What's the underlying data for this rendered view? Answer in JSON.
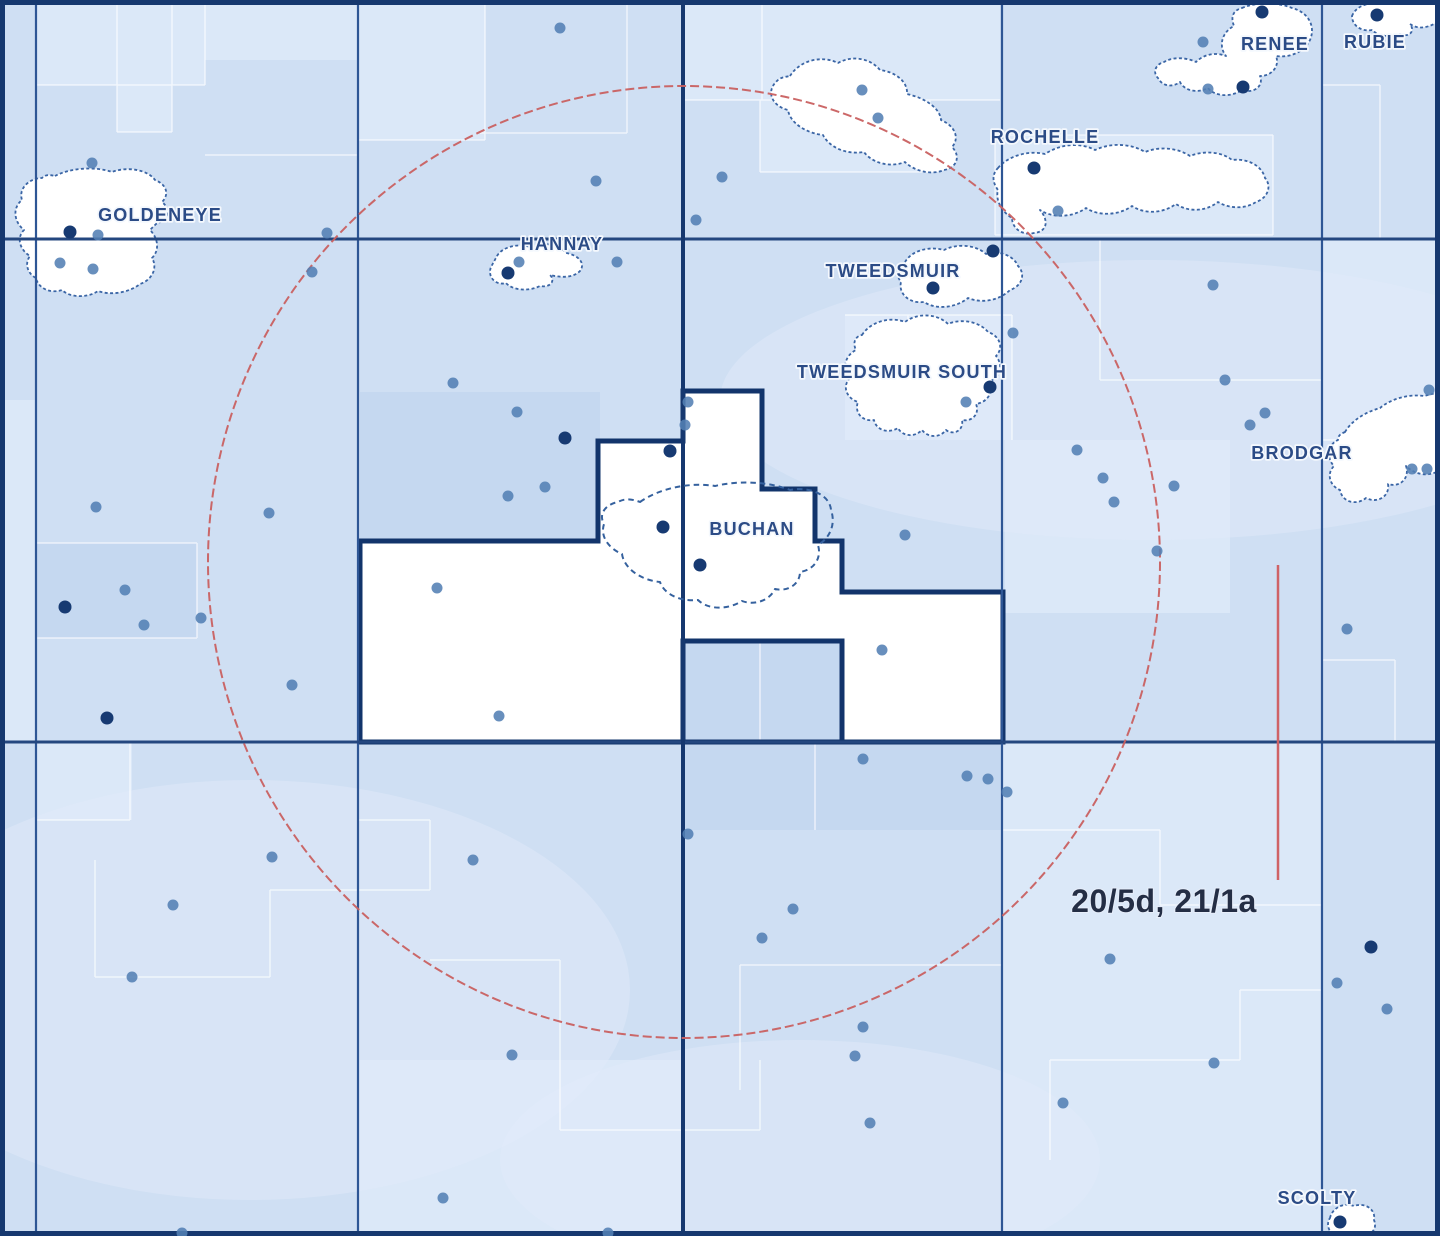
{
  "map": {
    "title": "Offshore licence blocks and fields map",
    "region_label": "20/5d, 21/1a",
    "fields": [
      {
        "id": "goldeneye",
        "label": "GOLDENEYE",
        "x": 160,
        "y": 221
      },
      {
        "id": "hannay",
        "label": "HANNAY",
        "x": 562,
        "y": 250
      },
      {
        "id": "rochelle",
        "label": "ROCHELLE",
        "x": 1045,
        "y": 143
      },
      {
        "id": "renee",
        "label": "RENEE",
        "x": 1275,
        "y": 50
      },
      {
        "id": "rubie",
        "label": "RUBIE",
        "x": 1375,
        "y": 48
      },
      {
        "id": "tweedsmuir",
        "label": "TWEEDSMUIR",
        "x": 893,
        "y": 277
      },
      {
        "id": "tweedsmuir-south",
        "label": "TWEEDSMUIR SOUTH",
        "x": 902,
        "y": 378
      },
      {
        "id": "buchan",
        "label": "BUCHAN",
        "x": 752,
        "y": 535
      },
      {
        "id": "brodgar",
        "label": "BRODGAR",
        "x": 1302,
        "y": 459
      },
      {
        "id": "scolty",
        "label": "SCOLTY",
        "x": 1317,
        "y": 1204
      }
    ],
    "colors": {
      "sea_base": "#cfdff3",
      "sea_light": "#dbe8f8",
      "sea_dark": "#c5d8f0",
      "grid_line": "#2e5695",
      "grid_major": "#16386f",
      "field_fill": "#ffffff",
      "field_outline": "#3a65a5",
      "licence_outline": "#12346b",
      "field_label_text": "#2b4b86",
      "block_label_text": "#242e45",
      "well_medium": "#537fb4",
      "well_dark": "#173a72",
      "radius_ring_red": "#c96060"
    },
    "wells": [
      [
        560,
        28
      ],
      [
        862,
        90
      ],
      [
        878,
        118
      ],
      [
        1203,
        42
      ],
      [
        1243,
        87,
        "d"
      ],
      [
        1208,
        89
      ],
      [
        1262,
        12,
        "d"
      ],
      [
        1377,
        15,
        "d"
      ],
      [
        92,
        163
      ],
      [
        70,
        232,
        "d"
      ],
      [
        98,
        235
      ],
      [
        60,
        263
      ],
      [
        93,
        269
      ],
      [
        327,
        233
      ],
      [
        312,
        272
      ],
      [
        596,
        181
      ],
      [
        722,
        177
      ],
      [
        696,
        220
      ],
      [
        1034,
        168,
        "d"
      ],
      [
        1058,
        211
      ],
      [
        1213,
        285
      ],
      [
        519,
        262
      ],
      [
        508,
        273,
        "d"
      ],
      [
        617,
        262
      ],
      [
        933,
        288,
        "d"
      ],
      [
        993,
        251,
        "d"
      ],
      [
        1013,
        333
      ],
      [
        453,
        383
      ],
      [
        517,
        412
      ],
      [
        565,
        438,
        "d"
      ],
      [
        545,
        487
      ],
      [
        508,
        496
      ],
      [
        990,
        387,
        "d"
      ],
      [
        966,
        402
      ],
      [
        1429,
        390
      ],
      [
        1225,
        380
      ],
      [
        1250,
        425
      ],
      [
        1265,
        413
      ],
      [
        1077,
        450
      ],
      [
        1103,
        478
      ],
      [
        1114,
        502
      ],
      [
        1174,
        486
      ],
      [
        1412,
        469
      ],
      [
        1427,
        469
      ],
      [
        1157,
        551
      ],
      [
        1347,
        629
      ],
      [
        688,
        402
      ],
      [
        685,
        425
      ],
      [
        670,
        451,
        "d"
      ],
      [
        663,
        527,
        "d"
      ],
      [
        700,
        565,
        "d"
      ],
      [
        905,
        535
      ],
      [
        882,
        650
      ],
      [
        437,
        588
      ],
      [
        499,
        716
      ],
      [
        96,
        507
      ],
      [
        269,
        513
      ],
      [
        125,
        590
      ],
      [
        65,
        607,
        "d"
      ],
      [
        201,
        618
      ],
      [
        144,
        625
      ],
      [
        292,
        685
      ],
      [
        107,
        718,
        "d"
      ],
      [
        863,
        759
      ],
      [
        967,
        776
      ],
      [
        988,
        779
      ],
      [
        1007,
        792
      ],
      [
        272,
        857
      ],
      [
        473,
        860
      ],
      [
        173,
        905
      ],
      [
        132,
        977
      ],
      [
        688,
        834
      ],
      [
        793,
        909
      ],
      [
        762,
        938
      ],
      [
        512,
        1055
      ],
      [
        863,
        1027
      ],
      [
        855,
        1056
      ],
      [
        870,
        1123
      ],
      [
        1110,
        959
      ],
      [
        1063,
        1103
      ],
      [
        1214,
        1063
      ],
      [
        1337,
        983
      ],
      [
        1371,
        947,
        "d"
      ],
      [
        1387,
        1009
      ],
      [
        443,
        1198
      ],
      [
        182,
        1233
      ],
      [
        608,
        1233
      ],
      [
        1340,
        1222,
        "d"
      ]
    ]
  }
}
